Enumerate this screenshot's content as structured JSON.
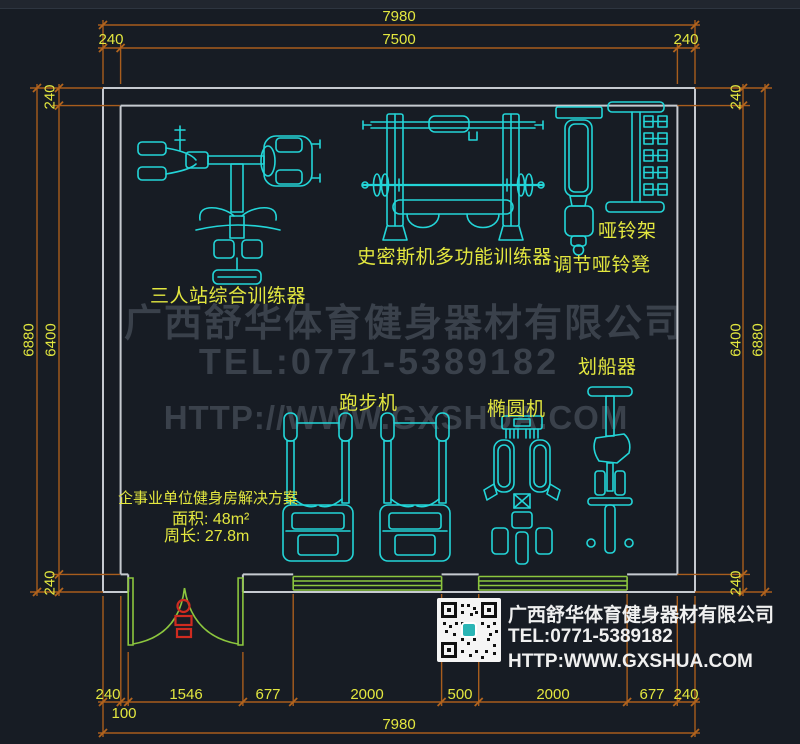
{
  "drawing": {
    "type": "gym floor plan (CAD)",
    "colors": {
      "background": "#171c24",
      "wall": "#c6cad0",
      "dimension_line": "#a85d1d",
      "dimension_text": "#e3e73f",
      "equipment_line": "#23d5d8",
      "door_window": "#8cc63e",
      "door_symbol": "#cf2b20",
      "watermark": "#3a414b",
      "footer_text": "#f0f0f0"
    }
  },
  "dimensions": {
    "top": {
      "overall": "7980",
      "left": "240",
      "middle": "7500",
      "right": "240"
    },
    "left": {
      "top": "240",
      "outer": "6880",
      "inner": "6400",
      "bottom": "240"
    },
    "right": {
      "top": "240",
      "inner": "6400",
      "outer": "6880",
      "bottom": "240"
    },
    "bottom": {
      "segments": [
        "240",
        "1546",
        "677",
        "2000",
        "500",
        "2000",
        "677",
        "240"
      ],
      "offset": "100",
      "overall": "7980"
    }
  },
  "equipment": {
    "multi_station": "三人站综合训练器",
    "smith": "史密斯机多功能训练器",
    "bench": "调节哑铃凳",
    "rack": "哑铃架",
    "treadmill": "跑步机",
    "elliptical": "椭圆机",
    "rower": "划船器"
  },
  "solution": {
    "title": "企事业单位健身房解决方案",
    "area": "面积: 48m²",
    "perimeter": "周长: 27.8m"
  },
  "watermark": {
    "company": "广西舒华体育健身器材有限公司",
    "tel": "TEL:0771-5389182",
    "url": "HTTP://WWW.GXSHUA.COM"
  },
  "footer": {
    "company": "广西舒华体育健身器材有限公司",
    "tel": "TEL:0771-5389182",
    "url": "HTTP:WWW.GXSHUA.COM"
  }
}
